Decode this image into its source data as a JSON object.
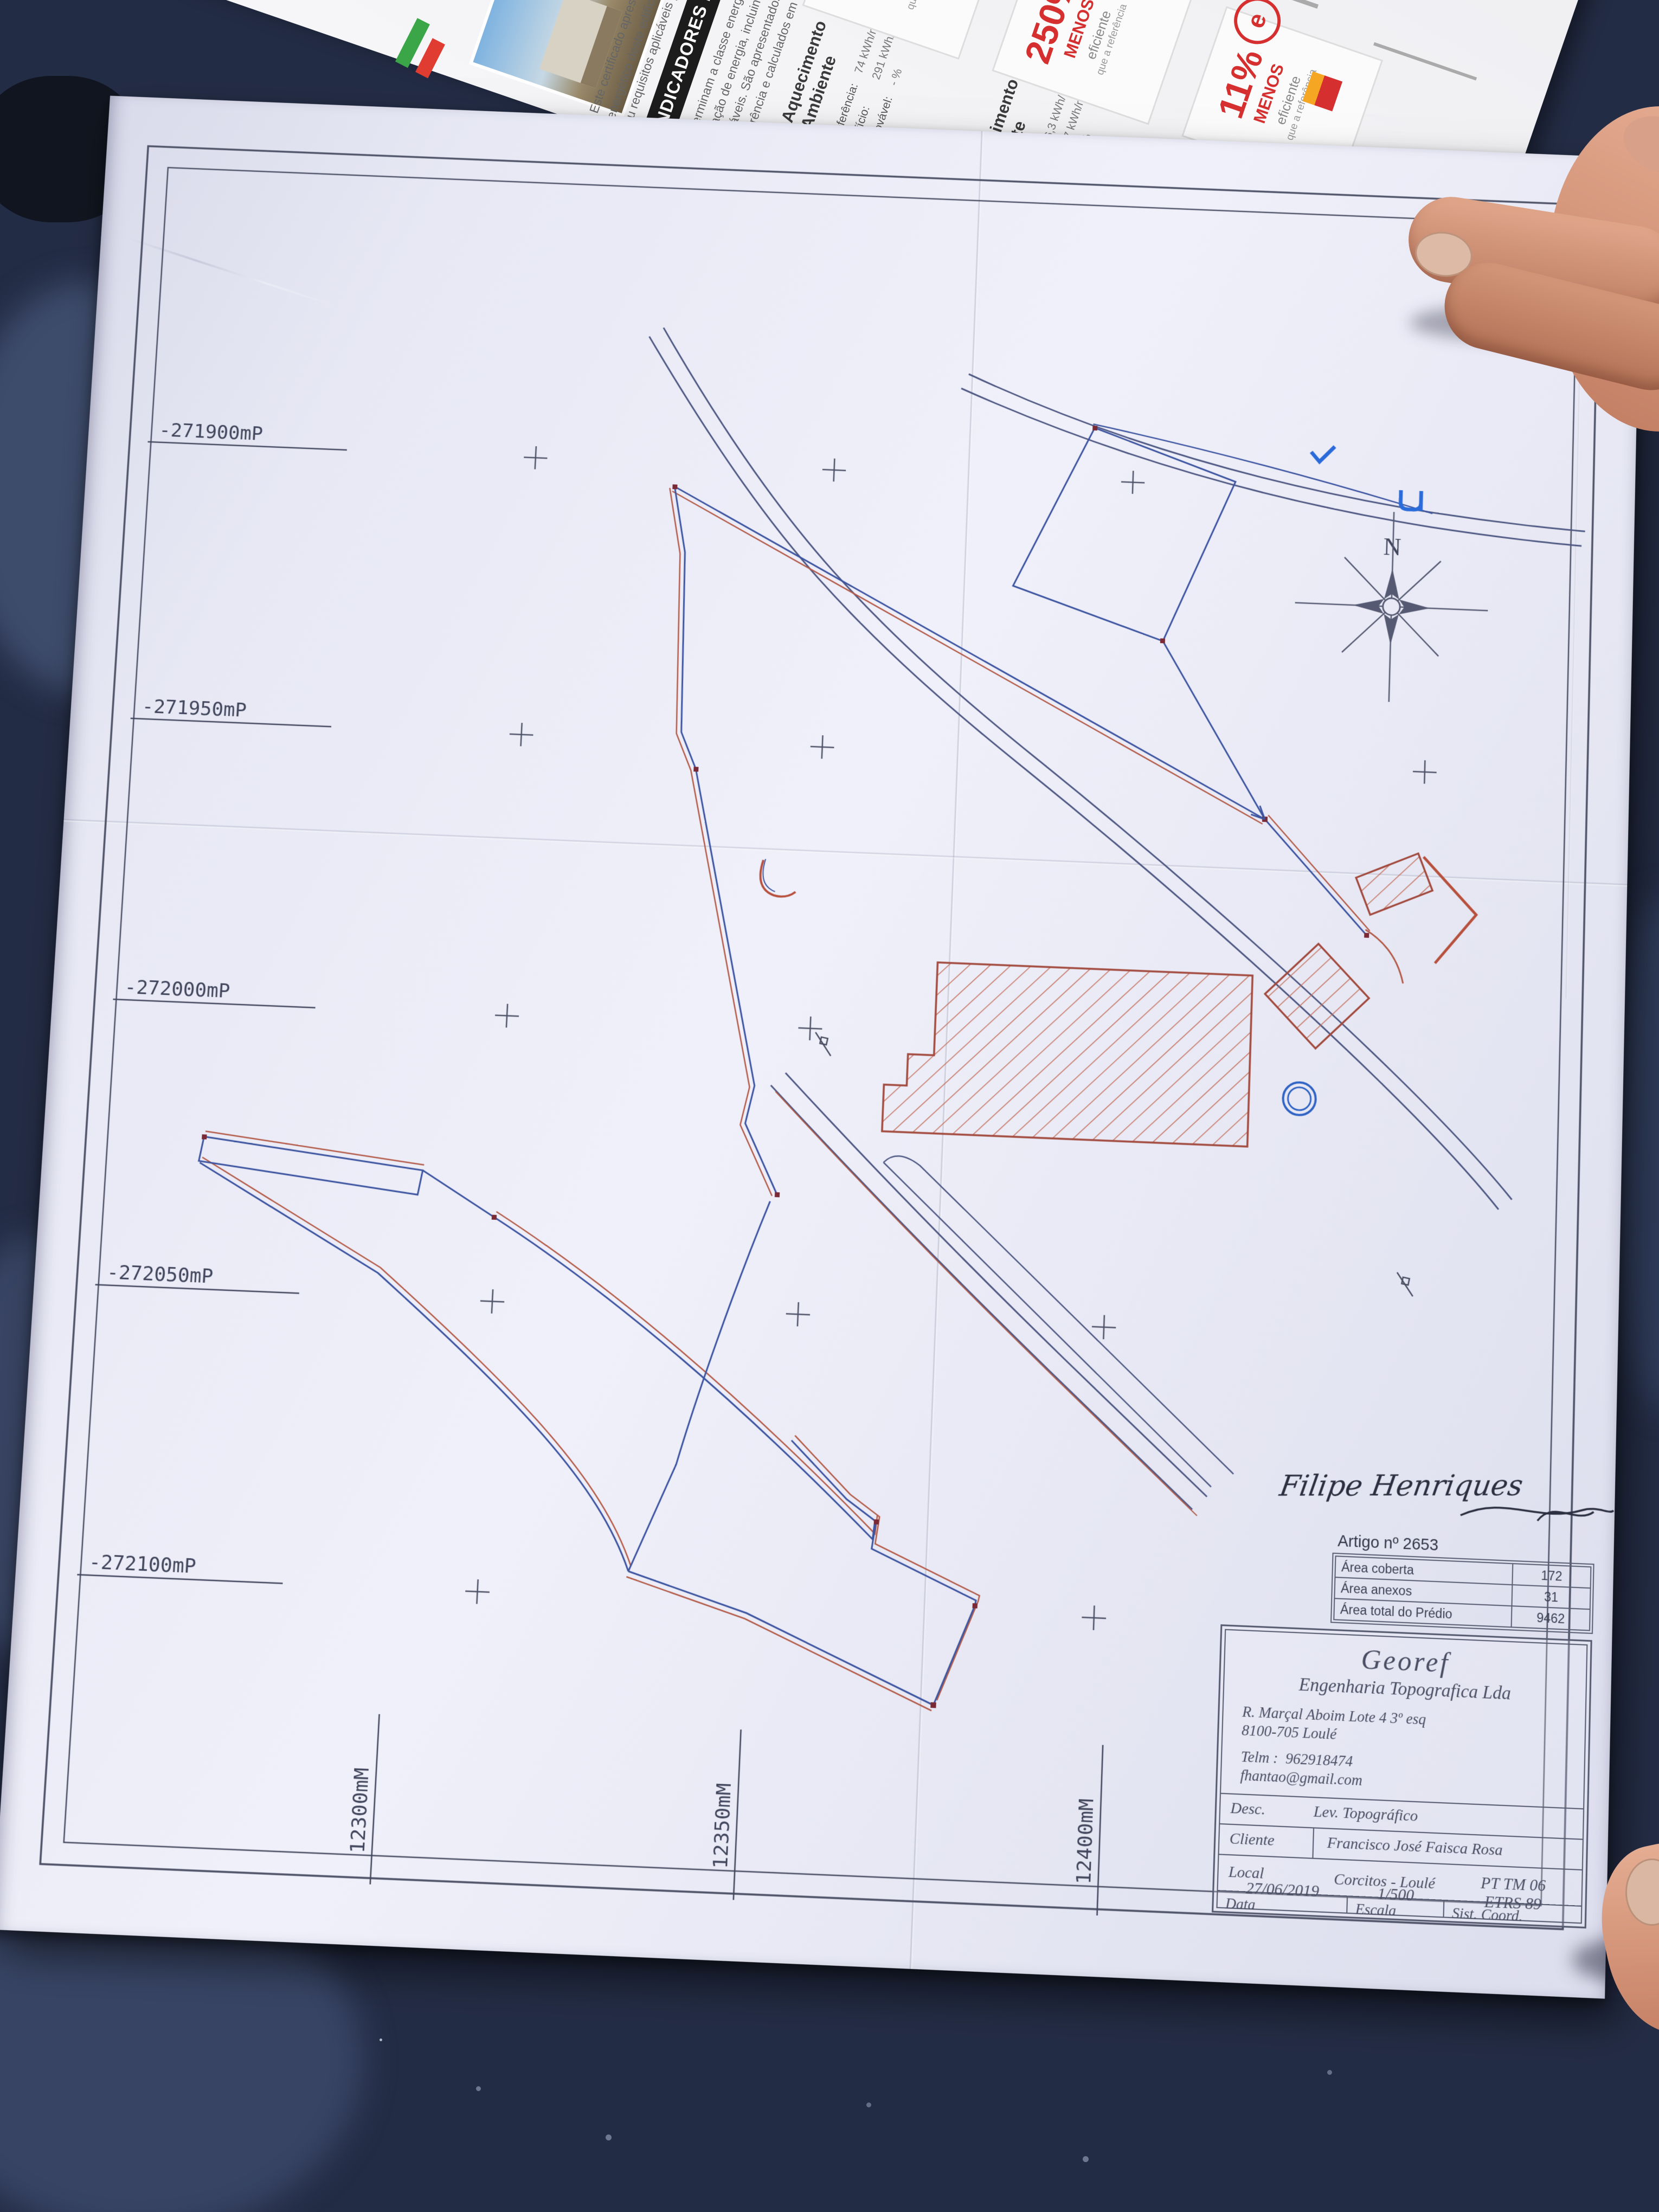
{
  "colors": {
    "table": "#232c45",
    "paper": "#e9e9f5",
    "ink": "#454a60",
    "boundary_blue": "#3c54a0",
    "boundary_red": "#b35a47",
    "hatch_red": "#c26a55",
    "leaflet_red": "#d5302f",
    "icon_heating": "#d93025",
    "icon_cooling": "#2d9fd8",
    "icon_dhw": "#e8842c"
  },
  "leaflet": {
    "banner": "INDICADORES DE DESEMPENHO",
    "intro": [
      "Este certificado apresenta a cl…",
      "energético deste edifício nas con…",
      "ou requisitos aplicáveis para o an…"
    ],
    "para": [
      "Determinam a classe energética do edifí…",
      "utilização de energia, incluindo o cons…",
      "renováveis. São apresentados comparati…",
      "de referência e calculados em condições…"
    ],
    "indicators": [
      {
        "icon": "heating-pinwheel-icon",
        "label1": "Aquecimento",
        "label2": "Ambiente",
        "ref_label": "Referência:",
        "ref_value": "74 kWh/m².ano",
        "bld_label": "Edifício:",
        "bld_value": "291 kWh/m².ano",
        "ren_label": "Renovável:",
        "ren_value": "- %",
        "pct": "250%",
        "word": "MENOS",
        "eff": "eficiente",
        "tail": "que a referência"
      },
      {
        "icon": "cooling-fan-icon",
        "label1": "Arrefecimento",
        "label2": "Ambiente",
        "ref_label": "Referência:",
        "ref_value": "6,3 kWh/m².ano",
        "bld_label": "Edifício:",
        "bld_value": "27 kWh/m².ano",
        "ren_label": "Renovável:",
        "ren_value": "- %",
        "pct": "250%",
        "word": "MENOS",
        "eff": "eficiente",
        "tail": "que a referência"
      },
      {
        "icon": "hot-water-icon",
        "label1": "Água Quente",
        "label2": "Sanitária",
        "ref_label": "Referência:",
        "ref_value": "19 kWh/m².ano",
        "bld_label": "Edifício:",
        "bld_value": "21 kWh/m².ano",
        "ren_label": "Renovável:",
        "ren_value": "- %",
        "pct": "11%",
        "word": "MENOS",
        "eff": "eficiente",
        "tail": "que a referência"
      }
    ],
    "logo_e": "e"
  },
  "plan": {
    "north_label": "N",
    "grid": {
      "left_labels": [
        "-271900mP",
        "-271950mP",
        "-272000mP",
        "-272050mP",
        "-272100mP"
      ],
      "bottom_labels": [
        "12300mM",
        "12350mM",
        "12400mM"
      ]
    },
    "signature": {
      "name": "Filipe Henriques"
    },
    "artigo": {
      "title": "Artigo nº 2653",
      "rows": [
        {
          "label": "Área coberta",
          "value": "172"
        },
        {
          "label": "Área anexos",
          "value": "31"
        },
        {
          "label": "Área total do Prédio",
          "value": "9462"
        }
      ]
    },
    "title_block": {
      "company": "Georef",
      "company_sub": "Engenharia Topografica Lda",
      "address1": "R. Marçal Aboim Lote 4 3º esq",
      "address2": "8100-705 Loulé",
      "phone_label": "Telm :",
      "phone": "962918474",
      "email": "fhantao@gmail.com",
      "desc_label": "Desc.",
      "desc_value": "Lev. Topográfico",
      "cliente_label": "Cliente",
      "cliente_value": "Francisco José Faisca Rosa",
      "local_label": "Local",
      "local_value": "Corcitos - Loulé",
      "data_label": "Data",
      "data_value": "27/06/2019",
      "escala_label": "Escala",
      "escala_value": "1/500",
      "coord_label": "Sist. Coord.",
      "coord_line1": "PT TM 06",
      "coord_line2": "ETRS 89"
    }
  }
}
